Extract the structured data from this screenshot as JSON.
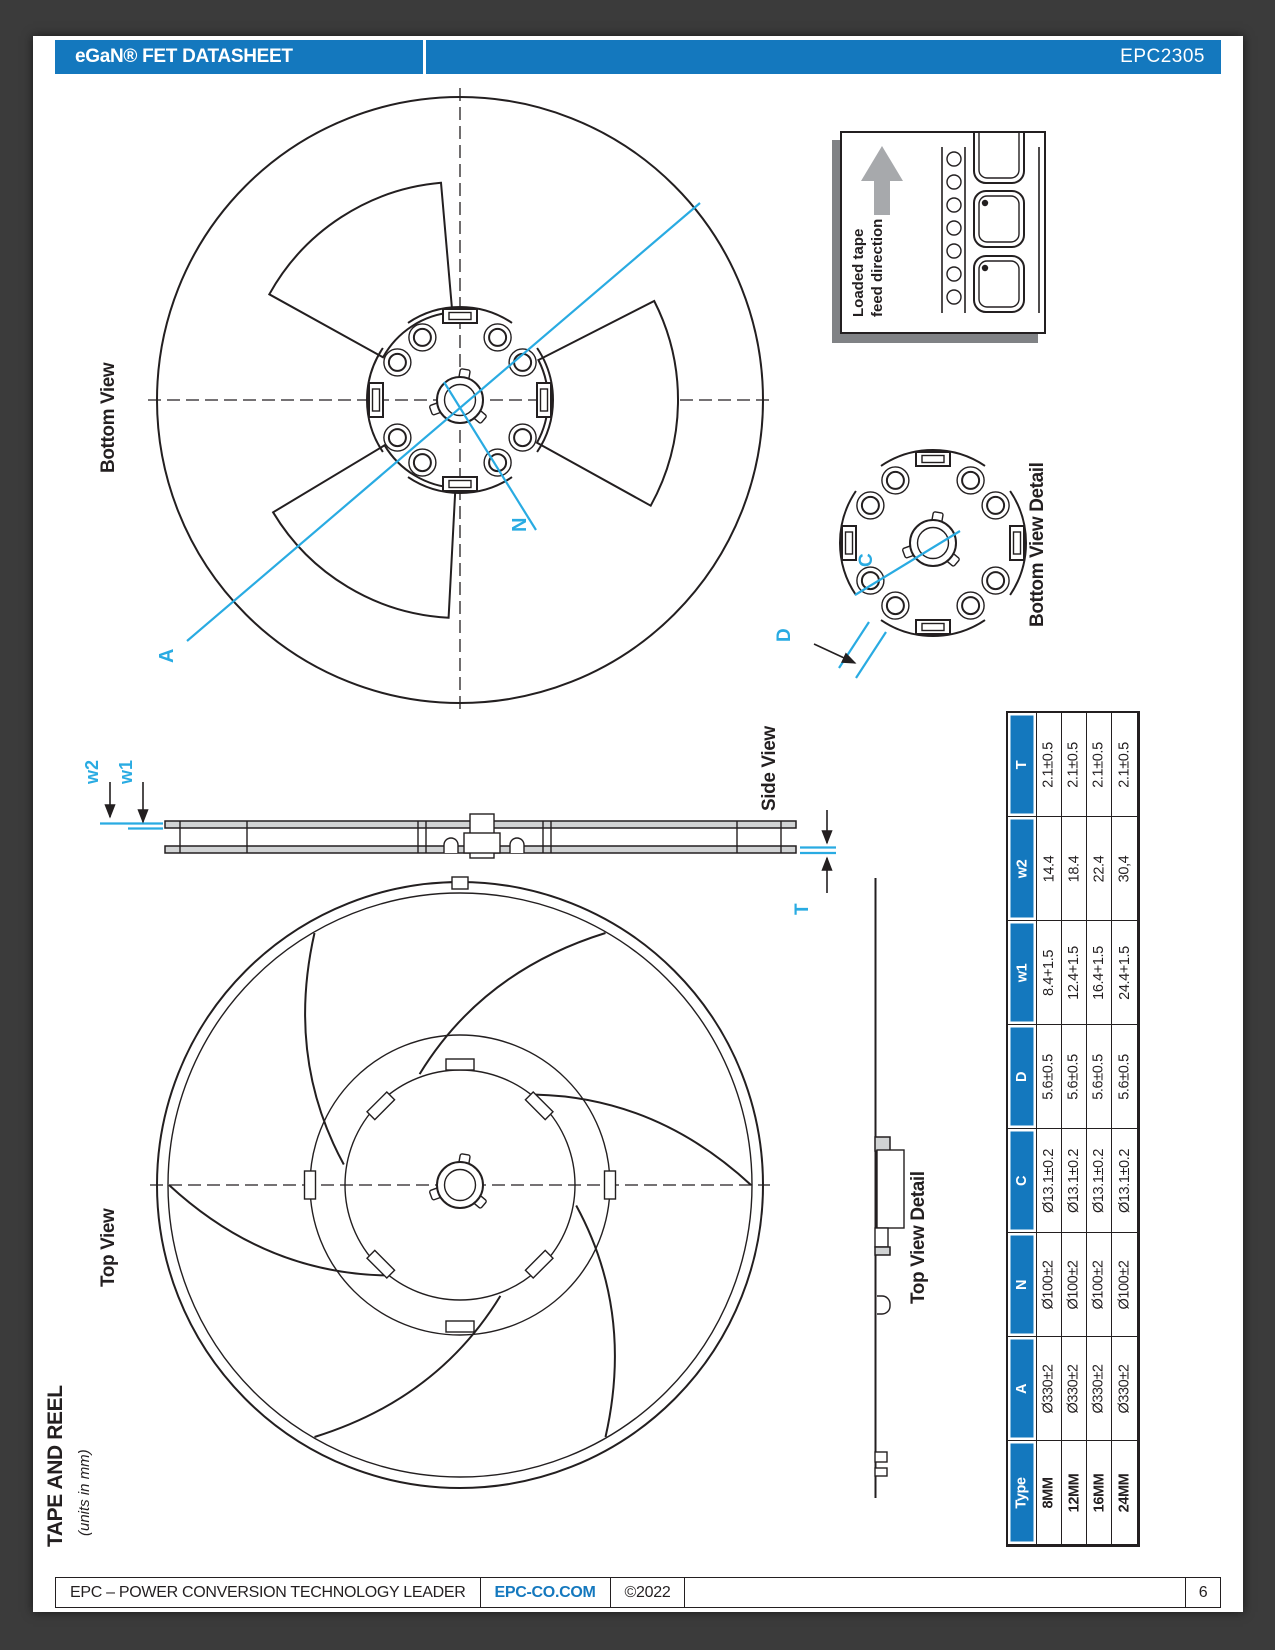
{
  "header": {
    "title": "eGaN® FET DATASHEET",
    "part_number": "EPC2305"
  },
  "footer": {
    "company": "EPC – POWER CONVERSION TECHNOLOGY LEADER",
    "website": "EPC-CO.COM",
    "copyright": "©2022",
    "page_number": "6"
  },
  "section": {
    "title": "TAPE AND REEL",
    "subtitle": "(units in mm)"
  },
  "labels": {
    "bottom_view": "Bottom View",
    "top_view": "Top View",
    "side_view": "Side View",
    "bottom_view_detail": "Bottom View Detail",
    "top_view_detail": "Top View Detail",
    "feed_line1": "Loaded tape",
    "feed_line2": "feed direction"
  },
  "dimensions": {
    "a": "A",
    "n": "N",
    "c": "C",
    "d": "D",
    "w1": "w1",
    "w2": "w2",
    "t": "T"
  },
  "colors": {
    "header_blue": "#1478BE",
    "dimension_cyan": "#29ABE2"
  },
  "table": {
    "columns": [
      "Type",
      "A",
      "N",
      "C",
      "D",
      "w1",
      "w2",
      "T"
    ],
    "rows": [
      [
        "8MM",
        "Ø330±2",
        "Ø100±2",
        "Ø13.1±0.2",
        "5.6±0.5",
        "8.4+1.5",
        "14.4",
        "2.1±0.5"
      ],
      [
        "12MM",
        "Ø330±2",
        "Ø100±2",
        "Ø13.1±0.2",
        "5.6±0.5",
        "12.4+1.5",
        "18.4",
        "2.1±0.5"
      ],
      [
        "16MM",
        "Ø330±2",
        "Ø100±2",
        "Ø13.1±0.2",
        "5.6±0.5",
        "16.4+1.5",
        "22.4",
        "2.1±0.5"
      ],
      [
        "24MM",
        "Ø330±2",
        "Ø100±2",
        "Ø13.1±0.2",
        "5.6±0.5",
        "24.4+1.5",
        "30,4",
        "2.1±0.5"
      ]
    ]
  }
}
